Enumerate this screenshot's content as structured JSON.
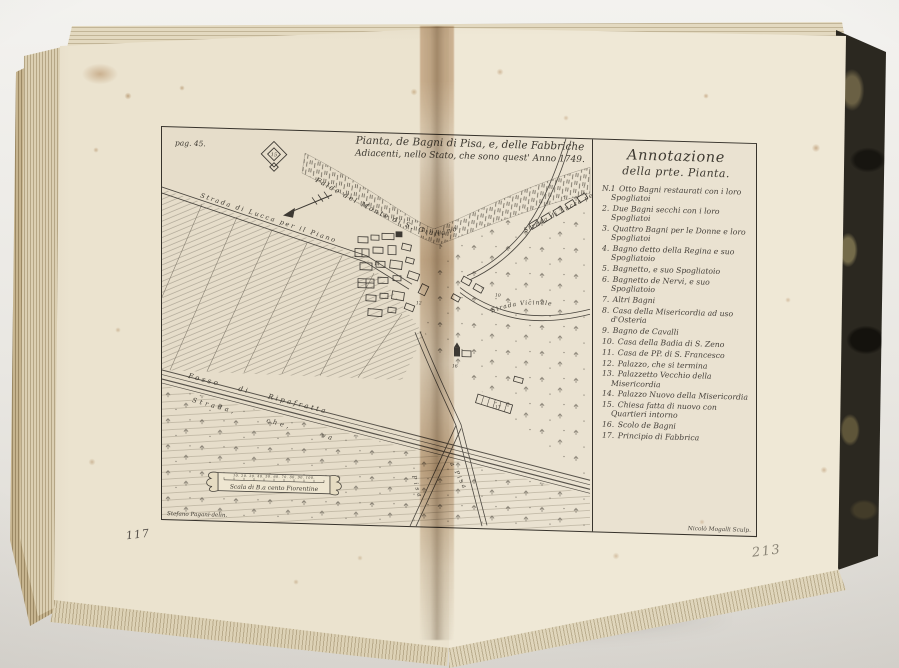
{
  "photo": {
    "left_page_number": "117",
    "pencil_number": "213"
  },
  "plate": {
    "page_ref": "pag. 45.",
    "title_line1": "Pianta, de Bagni di Pisa, e, delle Fabbriche",
    "title_line2": "Adiacenti, nello Stato, che sono quest' Anno 1749.",
    "signature_left": "Stefano Pagani delin.",
    "signature_right": "Nicolò Mogalli Sculp.",
    "scale": {
      "ticks": "10. 20. 30. 40. 50. 60. 70. 80. 90. 100.",
      "label": "Scala di B.a cento Fiorentine"
    },
    "map_labels": {
      "mountain": "Falde del Monte di S. Giuliano",
      "road_lucca_piano": "Strada di Lucca per il Piano",
      "road_lucca_monte": "Strada di Lucca per il Monte",
      "road_vicinale": "Strada Vicinale",
      "canal": "Fosso di Ripafratta",
      "road_pisa": "Strada, che, va",
      "road_pisa_2": "a Pisa",
      "road_pisa_vertical": "Pisa",
      "fort_number": "15",
      "marker_10": "10",
      "marker_12": "12",
      "marker_14": "14",
      "marker_16": "16",
      "marker_17": "17"
    },
    "annotation": {
      "header_line1": "Annotazione",
      "header_line2": "della prte. Pianta.",
      "items": [
        {
          "n": "N.1",
          "t": "Otto Bagni restaurati con i loro Spogliatoi"
        },
        {
          "n": "2.",
          "t": "Due Bagni secchi con i loro Spogliatoi"
        },
        {
          "n": "3.",
          "t": "Quattro Bagni per le Donne e loro Spogliatoi"
        },
        {
          "n": "4.",
          "t": "Bagno detto della Regina e suo Spogliatoio"
        },
        {
          "n": "5.",
          "t": "Bagnetto, e suo Spogliatoio"
        },
        {
          "n": "6.",
          "t": "Bagnetto de Nervi, e suo Spogliatoio"
        },
        {
          "n": "7.",
          "t": "Altri Bagni"
        },
        {
          "n": "8.",
          "t": "Casa della Misericordia ad uso d'Osteria"
        },
        {
          "n": "9.",
          "t": "Bagno de Cavalli"
        },
        {
          "n": "10.",
          "t": "Casa della Badia di S. Zeno"
        },
        {
          "n": "11.",
          "t": "Casa de PP. di S. Francesco"
        },
        {
          "n": "12.",
          "t": "Palazzo, che si termina"
        },
        {
          "n": "13.",
          "t": "Palazzetto Vecchio della Misericordia"
        },
        {
          "n": "14.",
          "t": "Palazzo Nuovo della Misericordia"
        },
        {
          "n": "15.",
          "t": "Chiesa fatta di nuovo con Quartieri intorno"
        },
        {
          "n": "16.",
          "t": "Scolo de Bagni"
        },
        {
          "n": "17.",
          "t": "Principio di Fabbrica"
        }
      ]
    }
  }
}
